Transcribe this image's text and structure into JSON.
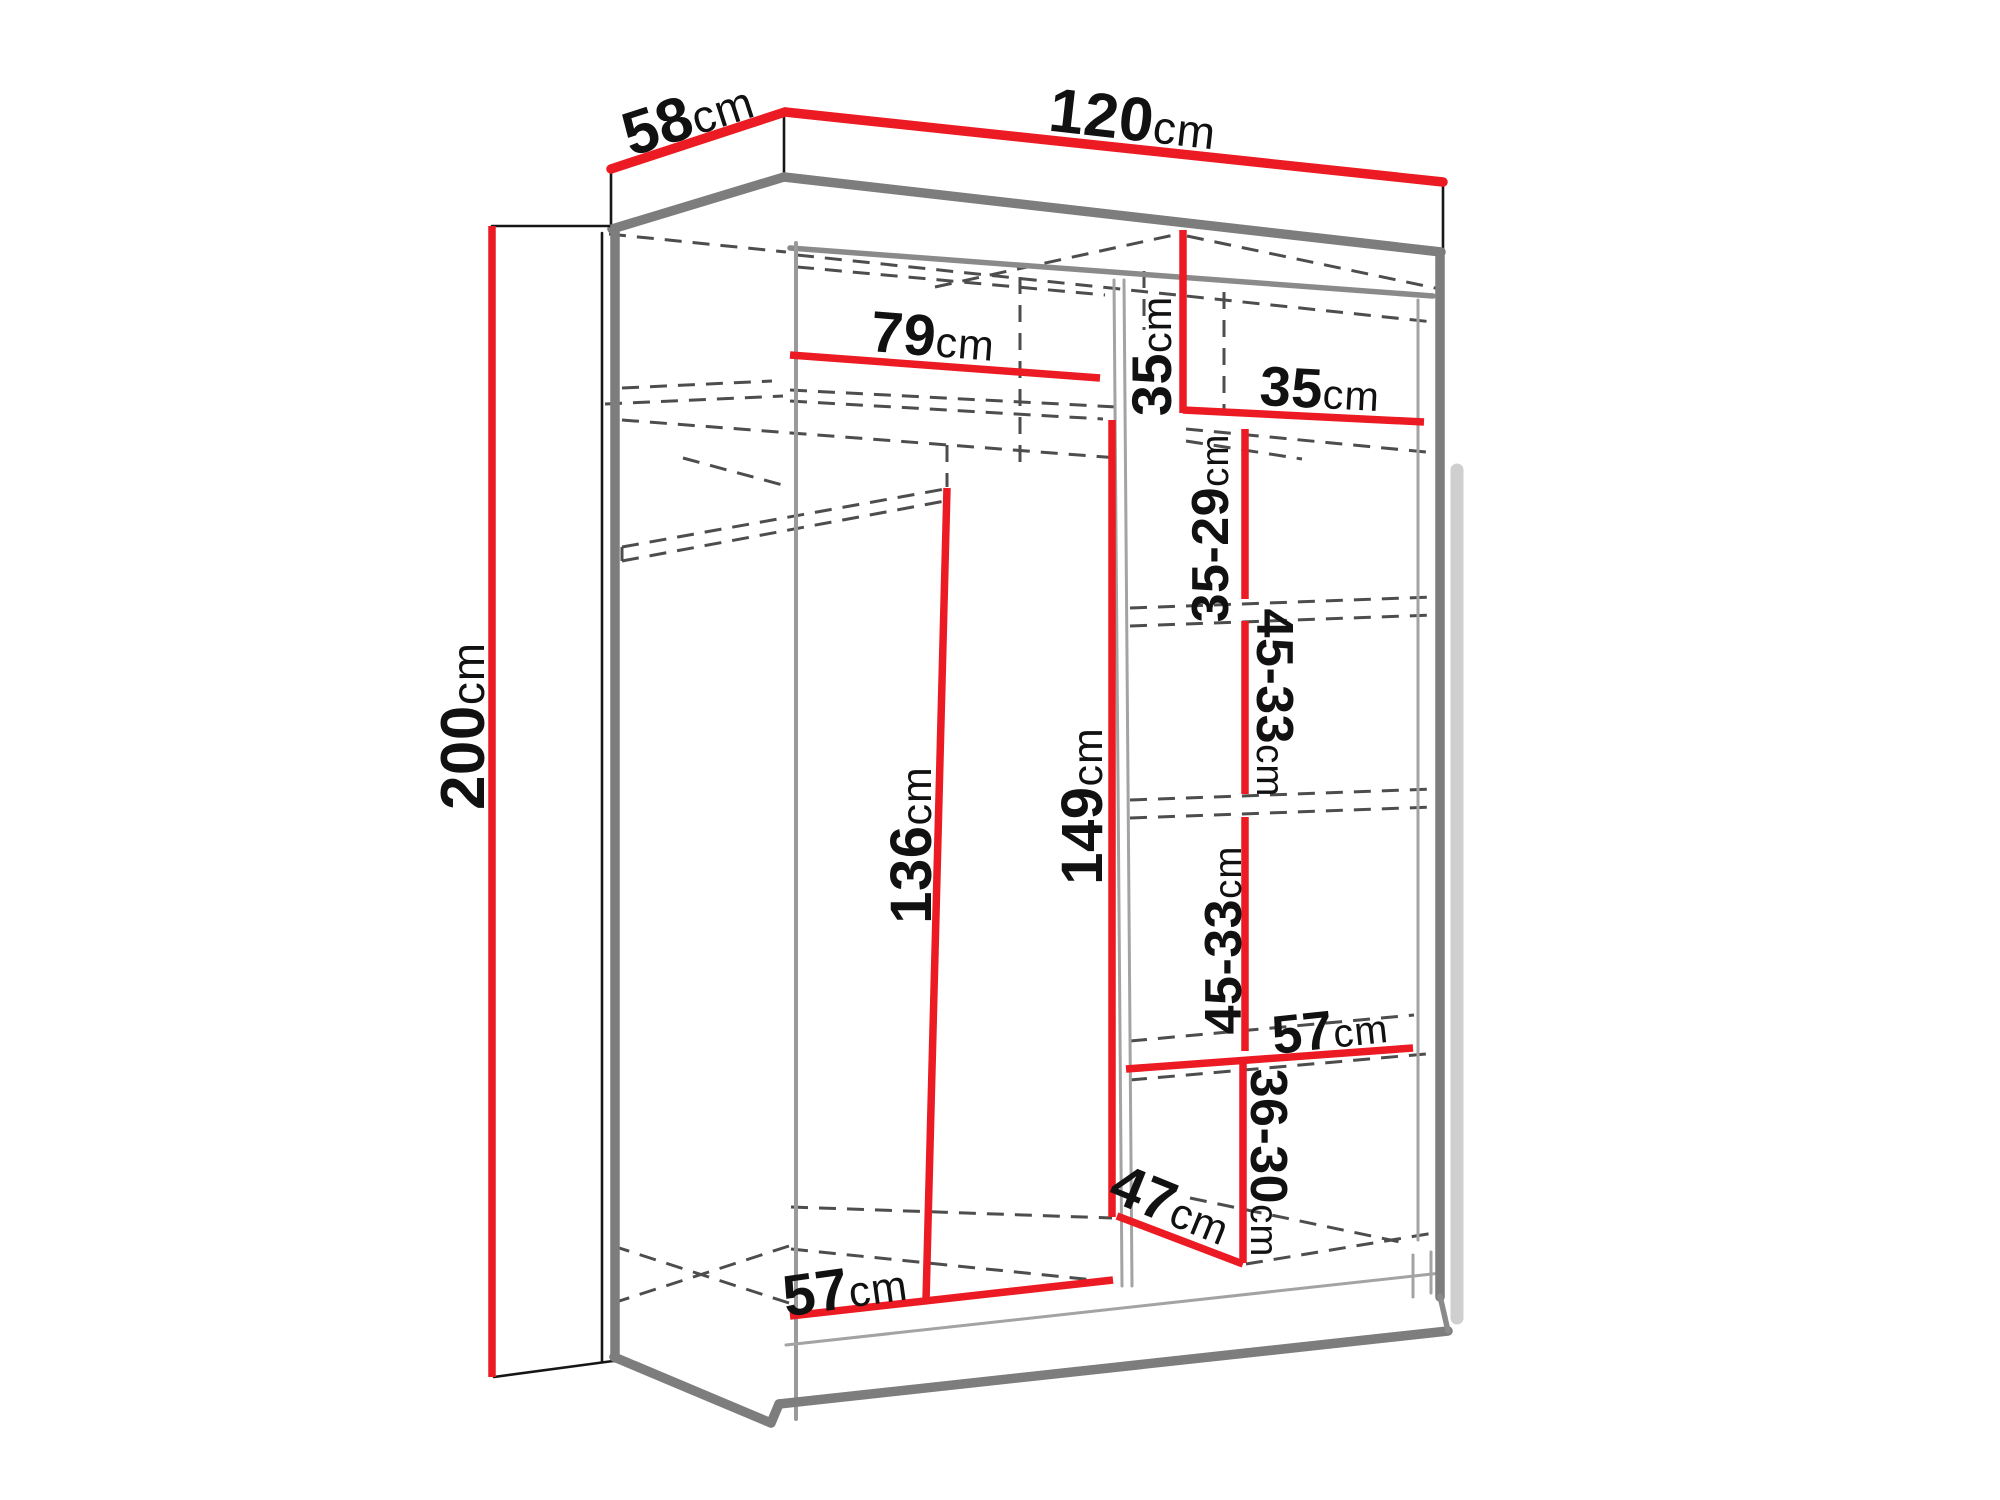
{
  "diagram": {
    "title": "Sliding wardrobe interior dimensions diagram",
    "unit": "cm",
    "colors": {
      "dimension_line": "#ec1b23",
      "structure_line": "#7d7d7d",
      "hidden_line": "#4d4d4d",
      "outline": "#161616",
      "background": "#ffffff"
    },
    "overall_dimensions": {
      "width": {
        "value": "120",
        "unit": "cm"
      },
      "depth": {
        "value": "58",
        "unit": "cm"
      },
      "height": {
        "value": "200",
        "unit": "cm"
      }
    },
    "interior_dimensions": {
      "left_shelf_width": {
        "value": "79",
        "unit": "cm"
      },
      "top_right_cubby_height": {
        "value": "35",
        "unit": "cm"
      },
      "top_right_cubby_width": {
        "value": "35",
        "unit": "cm"
      },
      "shelf_gap_1": {
        "value": "35-29",
        "unit": "cm"
      },
      "shelf_gap_2": {
        "value": "45-33",
        "unit": "cm"
      },
      "shelf_gap_3": {
        "value": "45-33",
        "unit": "cm"
      },
      "shelf_gap_4": {
        "value": "36-30",
        "unit": "cm"
      },
      "left_hanging_height": {
        "value": "136",
        "unit": "cm"
      },
      "center_hanging_height": {
        "value": "149",
        "unit": "cm"
      },
      "right_shelf_width": {
        "value": "57",
        "unit": "cm"
      },
      "bottom_right_depth_diagonal": {
        "value": "47",
        "unit": "cm"
      },
      "left_floor_width": {
        "value": "57",
        "unit": "cm"
      }
    },
    "labels": [
      {
        "id": "depth-58",
        "value": "58",
        "unit": "cm",
        "x": 688,
        "y": 117,
        "rot": -18,
        "size": 62
      },
      {
        "id": "width-120",
        "value": "120",
        "unit": "cm",
        "x": 1133,
        "y": 120,
        "rot": 6.5,
        "size": 62
      },
      {
        "id": "height-200",
        "value": "200",
        "unit": "cm",
        "x": 464,
        "y": 726,
        "rot": -90,
        "size": 62
      },
      {
        "id": "shelf-79",
        "value": "79",
        "unit": "cm",
        "x": 933,
        "y": 337,
        "rot": 4.5,
        "size": 58
      },
      {
        "id": "cubby-height-35",
        "value": "35",
        "unit": "cm",
        "x": 1152,
        "y": 356,
        "rot": -90,
        "size": 56
      },
      {
        "id": "cubby-width-35",
        "value": "35",
        "unit": "cm",
        "x": 1320,
        "y": 389,
        "rot": 3,
        "size": 56
      },
      {
        "id": "gap-35-29",
        "value": "35-29",
        "unit": "cm",
        "x": 1211,
        "y": 528,
        "rot": -90,
        "size": 52
      },
      {
        "id": "gap-45-33-a",
        "value": "45-33",
        "unit": "cm",
        "x": 1274,
        "y": 703,
        "rot": 90,
        "size": 52
      },
      {
        "id": "gap-45-33-b",
        "value": "45-33",
        "unit": "cm",
        "x": 1224,
        "y": 940,
        "rot": -90,
        "size": 52
      },
      {
        "id": "shelf-57-right",
        "value": "57",
        "unit": "cm",
        "x": 1330,
        "y": 1030,
        "rot": -6,
        "size": 54
      },
      {
        "id": "gap-36-30",
        "value": "36-30",
        "unit": "cm",
        "x": 1268,
        "y": 1163,
        "rot": 90,
        "size": 52
      },
      {
        "id": "hanging-136",
        "value": "136",
        "unit": "cm",
        "x": 912,
        "y": 845,
        "rot": -90,
        "size": 58
      },
      {
        "id": "hanging-149",
        "value": "149",
        "unit": "cm",
        "x": 1083,
        "y": 806,
        "rot": -90,
        "size": 58
      },
      {
        "id": "diagonal-47",
        "value": "47",
        "unit": "cm",
        "x": 1171,
        "y": 1205,
        "rot": 22,
        "size": 58
      },
      {
        "id": "floor-57-left",
        "value": "57",
        "unit": "cm",
        "x": 845,
        "y": 1289,
        "rot": -8,
        "size": 58
      }
    ]
  }
}
